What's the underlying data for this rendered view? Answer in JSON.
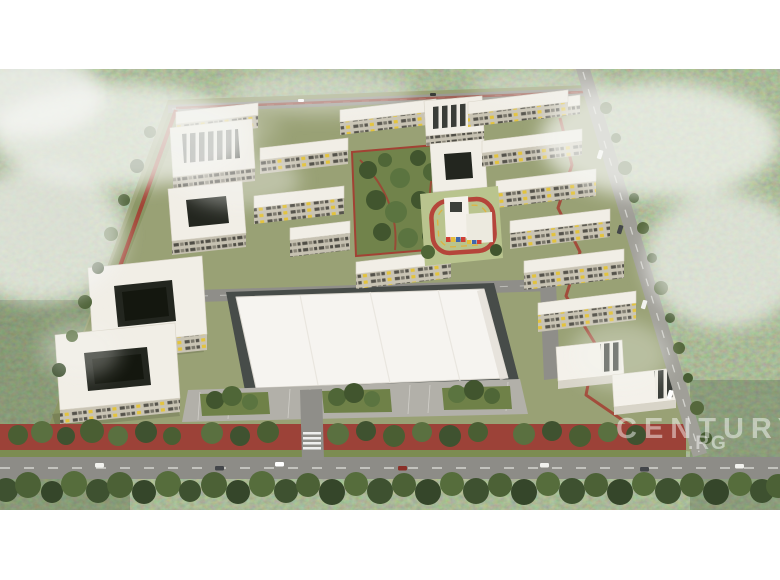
{
  "watermark": {
    "line1": "CENTURY 21",
    "line2": ".RG"
  },
  "palette": {
    "letterbox": "#ffffff",
    "forest": "#77825c",
    "fog": "#f4f5f2",
    "roof_white": "#f1eee6",
    "facade": "#c6c1b1",
    "window_dark": "#504e46",
    "accent_yellow": "#e3c33c",
    "track_red": "#a33d31",
    "road_gray": "#8f8e89",
    "asphalt_dark": "#474c49",
    "parking_gray": "#b2b0a9",
    "site_lawn": "#99a175",
    "park_green": "#6f8249",
    "hedge_green": "#44562f",
    "kindergarten_band": [
      "#cf3f34",
      "#e6bd3a",
      "#3f67ad"
    ]
  },
  "scene": {
    "subject": "aerial-render-residential-complex",
    "regions": [
      "surrounding-forest",
      "fog-haze",
      "residential-site",
      "apartment-buildings",
      "central-park",
      "kindergarten-with-track",
      "shopping-center",
      "parking-lot",
      "perimeter-red-track",
      "main-road",
      "diagonal-road",
      "tree-hedge"
    ]
  }
}
